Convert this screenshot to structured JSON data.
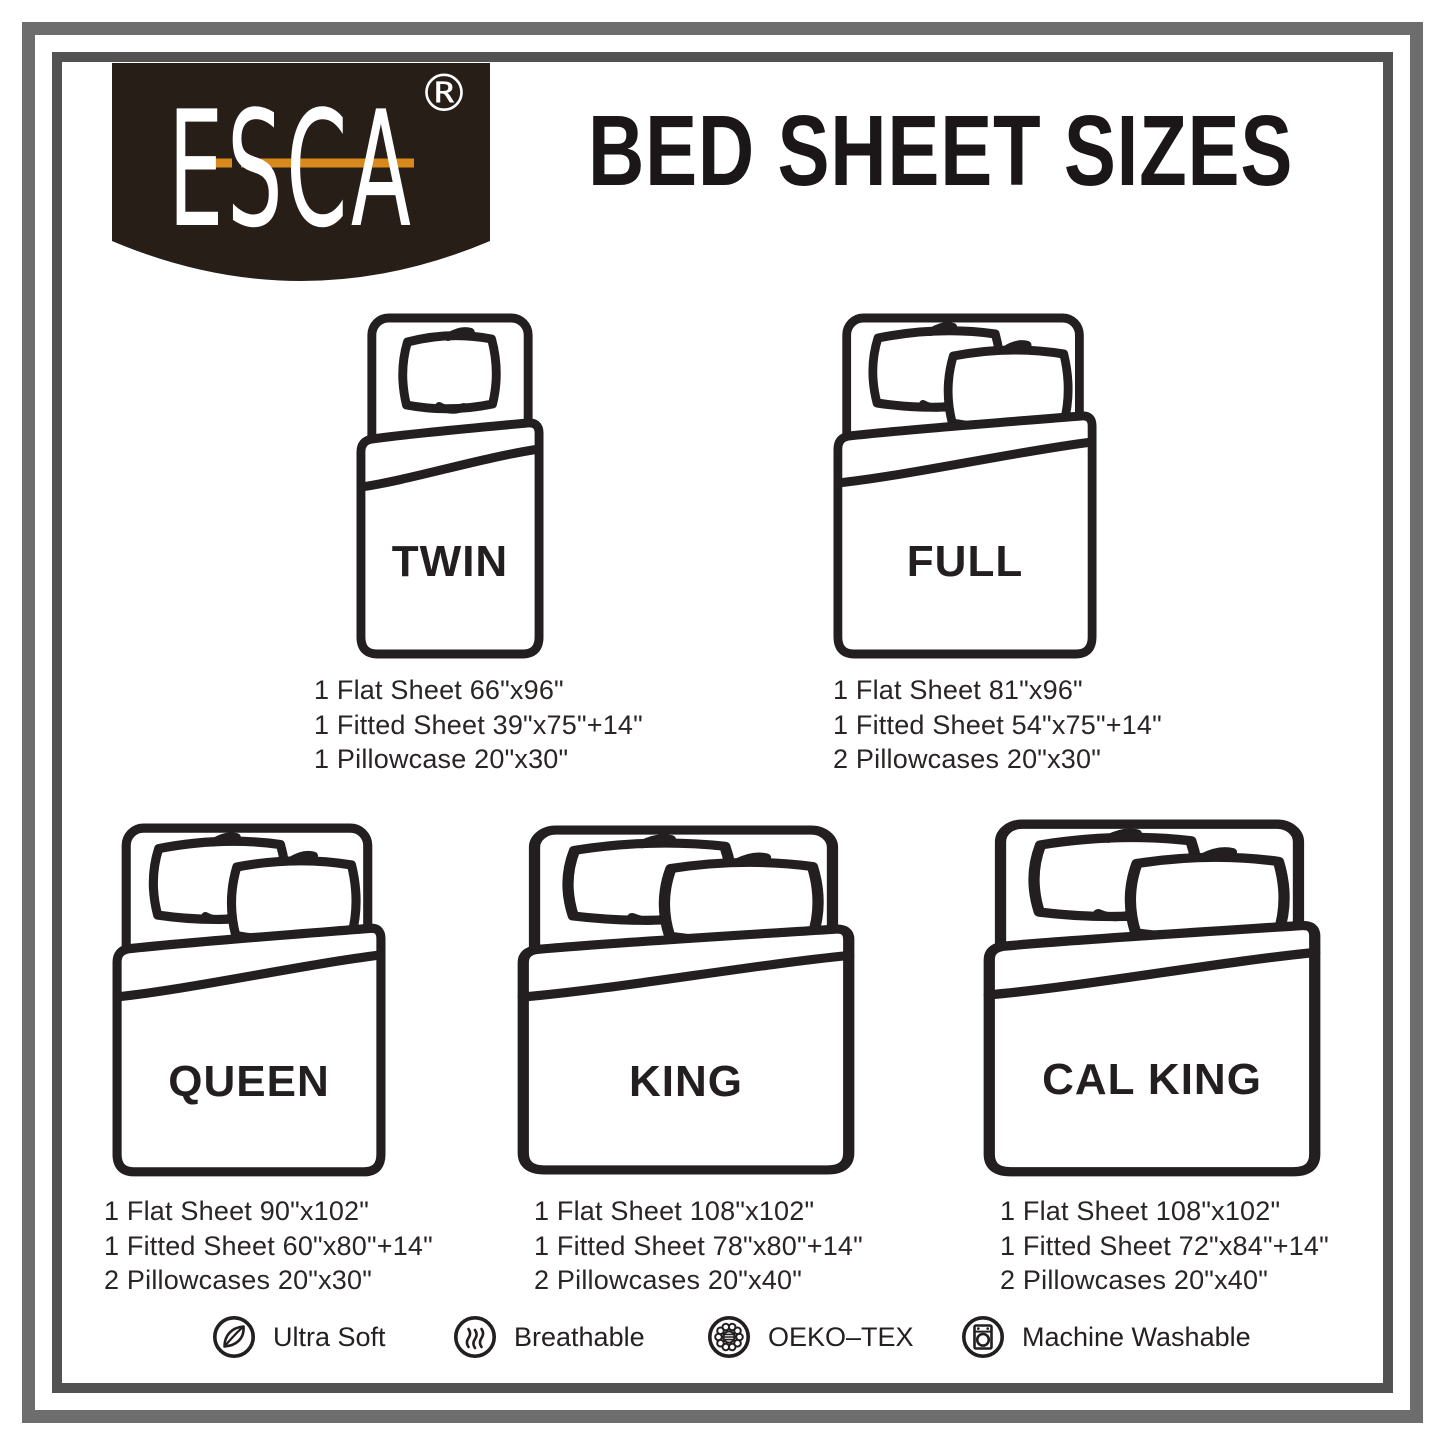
{
  "brand": {
    "name": "ESCA",
    "registered": "®",
    "badge_color": "#271e18",
    "accent_color": "#d9881c"
  },
  "title": "BED SHEET SIZES",
  "sizes": [
    {
      "id": "twin",
      "label": "TWIN",
      "pillows": 1,
      "specs": [
        "1 Flat Sheet 66\"x96\"",
        "1 Fitted Sheet 39\"x75\"+14\"",
        "1 Pillowcase 20\"x30\""
      ]
    },
    {
      "id": "full",
      "label": "FULL",
      "pillows": 2,
      "specs": [
        "1 Flat Sheet 81\"x96\"",
        "1 Fitted Sheet 54\"x75\"+14\"",
        "2 Pillowcases 20\"x30\""
      ]
    },
    {
      "id": "queen",
      "label": "QUEEN",
      "pillows": 2,
      "specs": [
        "1 Flat Sheet 90\"x102\"",
        "1 Fitted Sheet 60\"x80\"+14\"",
        "2 Pillowcases 20\"x30\""
      ]
    },
    {
      "id": "king",
      "label": "KING",
      "pillows": 2,
      "specs": [
        "1 Flat Sheet 108\"x102\"",
        "1 Fitted Sheet 78\"x80\"+14\"",
        "2 Pillowcases 20\"x40\""
      ]
    },
    {
      "id": "cal_king",
      "label": "CAL KING",
      "pillows": 2,
      "specs": [
        "1 Flat Sheet 108\"x102\"",
        "1 Fitted Sheet 72\"x84\"+14\"",
        "2 Pillowcases 20\"x40\""
      ]
    }
  ],
  "features": [
    {
      "label": "Ultra Soft",
      "icon": "leaf-icon"
    },
    {
      "label": "Breathable",
      "icon": "airflow-icon"
    },
    {
      "label": "OEKO–TEX",
      "icon": "oeko-tex-flower-icon"
    },
    {
      "label": "Machine Washable",
      "icon": "washing-machine-icon"
    }
  ]
}
